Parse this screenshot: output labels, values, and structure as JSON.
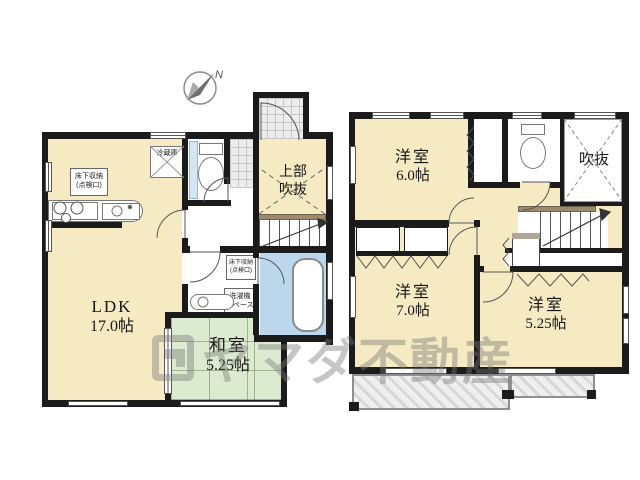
{
  "watermark": {
    "text": "ヤマダ不動産"
  },
  "compass": {
    "label": "N"
  },
  "floor1": {
    "rooms": {
      "ldk": {
        "name": "LDK",
        "size": "17.0帖"
      },
      "washitsu": {
        "name": "和室",
        "size": "5.25帖"
      },
      "entrance_void": {
        "line1": "上部",
        "line2": "吹抜"
      }
    },
    "labels": {
      "fridge": "冷蔵庫",
      "underfloor_kitchen_1": "床下収納",
      "underfloor_kitchen_2": "(点検口)",
      "underfloor_wash_1": "床下収納",
      "underfloor_wash_2": "(点検口)",
      "laundry_1": "洗濯機",
      "laundry_2": "スペース"
    }
  },
  "floor2": {
    "rooms": {
      "western1": {
        "name": "洋室",
        "size": "6.0帖"
      },
      "western2": {
        "name": "洋室",
        "size": "7.0帖"
      },
      "western3": {
        "name": "洋室",
        "size": "5.25帖"
      },
      "void": {
        "name": "吹抜"
      }
    }
  },
  "colors": {
    "wall": "#1b1b1b",
    "room_beige": "#f6eac3",
    "tatami_green": "#dcead0",
    "bath_blue": "#bcd7eb",
    "handrail_brown": "#9b8a6b",
    "balcony_gray": "#d8d8d8"
  }
}
